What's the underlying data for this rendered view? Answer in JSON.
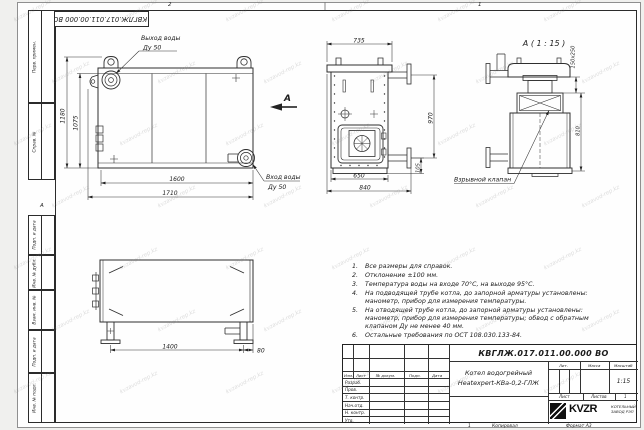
{
  "watermark": {
    "text": "kvzavod-rep.kz"
  },
  "frame": {
    "zone_2": "2",
    "zone_1": "1",
    "zone_a": "А",
    "margins": [
      "Перв. примен.",
      "Справ. №",
      "Подп. и дата",
      "Инв. № дубл.",
      "Взам. инв. №",
      "Подп. и дата",
      "Инв. № подл."
    ],
    "footer_num": "1",
    "footer_copy": "Копировал",
    "footer_format": "Формат А3"
  },
  "stamp": {
    "doc_number": "КВГЛЖ.017.011.00.000 ВО"
  },
  "views": {
    "front": {
      "outlet_label": "Выход воды",
      "outlet_size": "Ду 50",
      "inlet_label": "Вход воды",
      "inlet_size": "Ду 50",
      "arrow": "А",
      "dims": {
        "h_outer": "1180",
        "h_inner": "1075",
        "w_inner": "1600",
        "w_outer": "1710"
      }
    },
    "side": {
      "dims": {
        "top": "735",
        "right": "970",
        "b_inner": "650",
        "b_outer": "840",
        "pipe": "105"
      }
    },
    "detail": {
      "title": "А ( 1 : 15 )",
      "valve_label": "Взрывной клапан",
      "dims": {
        "flue": "150x250",
        "height": "810"
      }
    },
    "bottom": {
      "dims": {
        "span": "1400",
        "edge": "80"
      }
    }
  },
  "notes": {
    "items": [
      {
        "n": "1.",
        "t": "Все размеры для справок."
      },
      {
        "n": "2.",
        "t": "Отклонение ±100 мм."
      },
      {
        "n": "3.",
        "t": "Температура воды на входе 70°С, на выходе 95°С."
      },
      {
        "n": "4.",
        "t": "На подводящей трубе котла, до запорной арматуры установлены: манометр, прибор для измерения температуры."
      },
      {
        "n": "5.",
        "t": "На отводящей трубе котла, до запорной арматуры установлены: манометр, прибор для измерения температуры; обвод с обратным клапаном Ду не менее 40 мм."
      },
      {
        "n": "6.",
        "t": "Остальные требования по ОСТ 108.030.133-84."
      }
    ]
  },
  "title_block": {
    "doc_number": "КВГЛЖ.017.011.00.000 ВО",
    "name_line1": "Котел водогрейный",
    "name_line2": "Heatexpert-КВа-0,2-ГЛЖ",
    "headers": {
      "izm": "Изм.",
      "list": "Лист",
      "docnum": "№ докум.",
      "podp": "Подп.",
      "data": "Дата"
    },
    "rows": [
      "Разраб.",
      "Пров.",
      "Т. контр.",
      "Нач.отд.",
      "Н. контр.",
      "Утв."
    ],
    "lit": "Лит.",
    "massa": "Масса",
    "masshtab": "Масштаб",
    "scale": "1:15",
    "sheet_label": "Лист",
    "sheets_label": "Листов",
    "sheets_value": "1",
    "logo_text": "KVZR",
    "company_line1": "КОТЕЛЬНЫЙ",
    "company_line2": "ЗАВОД РЭП"
  }
}
